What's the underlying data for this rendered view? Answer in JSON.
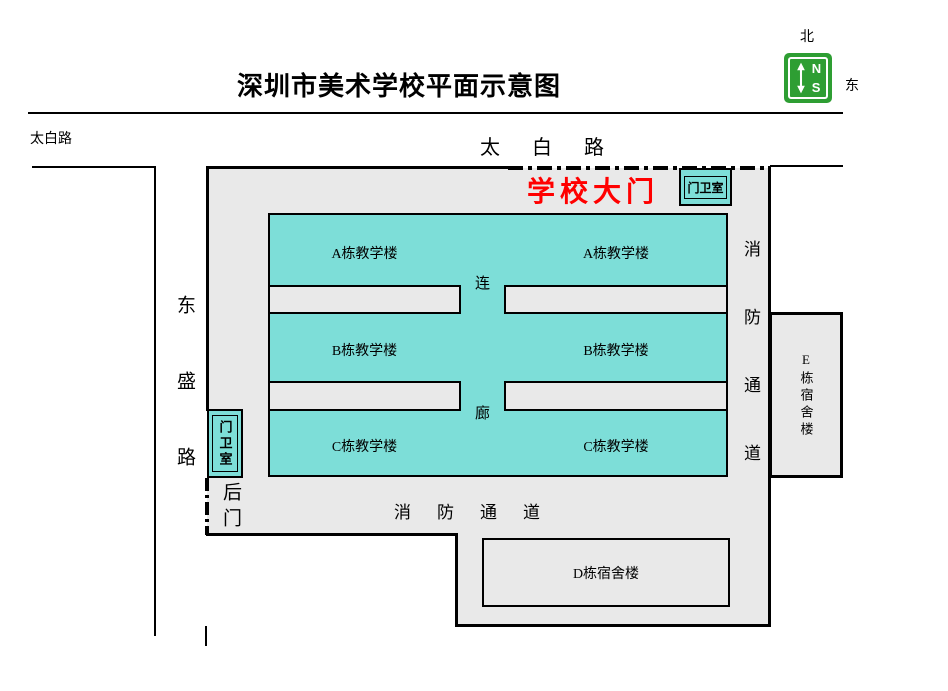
{
  "title": "深圳市美术学校平面示意图",
  "compass": {
    "north": "北",
    "east": "东",
    "n": "N",
    "s": "S"
  },
  "roads": {
    "taibai_corner": "太白路",
    "taibai": "太白路",
    "dongsheng": "东盛路"
  },
  "campus": {
    "main_gate": "学校大门",
    "back_gate": "后门",
    "gatehouse_top": "门卫室",
    "gatehouse_left": "门卫室",
    "fire_lane_vertical": "消防通道",
    "fire_lane_horizontal": "消防通道",
    "corridor_char_top": "连",
    "corridor_char_bottom": "廊"
  },
  "buildings": {
    "a_left": "A栋教学楼",
    "a_right": "A栋教学楼",
    "b_left": "B栋教学楼",
    "b_right": "B栋教学楼",
    "c_left": "C栋教学楼",
    "c_right": "C栋教学楼",
    "dorm_d": "D栋宿舍楼",
    "dorm_e": "E栋宿舍楼"
  },
  "colors": {
    "building_fill": "#7DDED8",
    "area_fill": "#E9E9E9",
    "gate_label": "#FF0000",
    "compass_green": "#2E9E33",
    "line": "#000000"
  }
}
